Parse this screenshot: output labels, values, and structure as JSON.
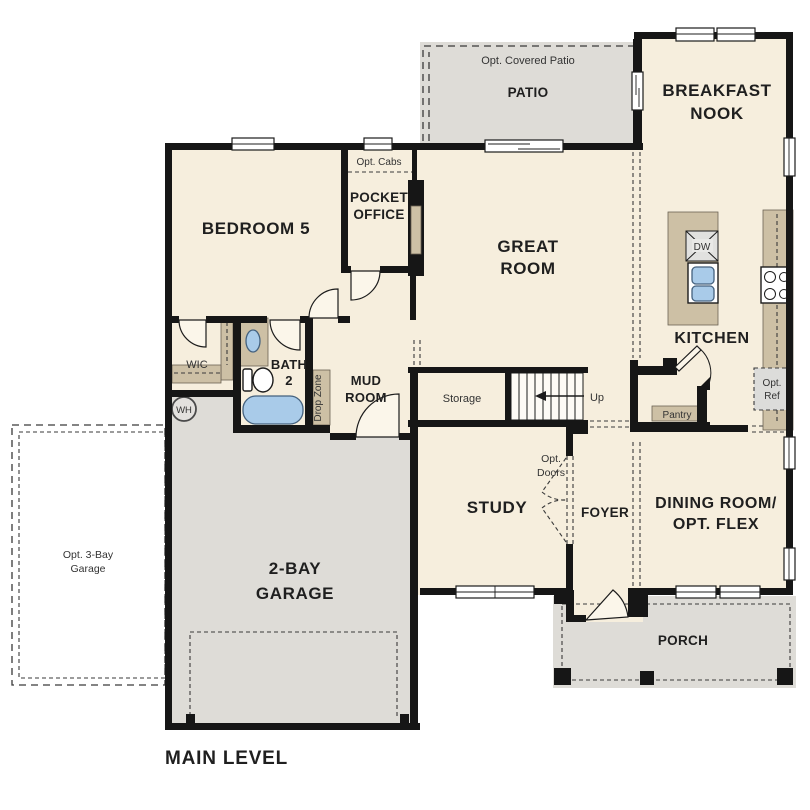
{
  "colors": {
    "floor": "#f6eedd",
    "outdoor": "#dedcd7",
    "wall": "#161616",
    "cabinetry": "#cdc0a5",
    "water_fixture": "#a9cbe9",
    "dashed_line": "#3a3a3a",
    "label_text": "#1f1f1f"
  },
  "outdoor": {
    "patio": {
      "label": "PATIO",
      "optional_label": "Opt. Covered Patio"
    },
    "porch": {
      "label": "PORCH"
    },
    "opt_garage": {
      "lines": [
        "Opt. 3-Bay",
        "Garage"
      ]
    }
  },
  "rooms": {
    "breakfast_nook": {
      "lines": [
        "BREAKFAST",
        "NOOK"
      ]
    },
    "bedroom5": {
      "label": "BEDROOM 5"
    },
    "pocket_office": {
      "lines": [
        "POCKET",
        "OFFICE"
      ],
      "optional_label": "Opt. Cabs"
    },
    "great_room": {
      "lines": [
        "GREAT",
        "ROOM"
      ]
    },
    "kitchen": {
      "label": "KITCHEN",
      "dishwasher": "DW",
      "pantry": "Pantry",
      "opt_ref_lines": [
        "Opt.",
        "Ref"
      ]
    },
    "wic": {
      "label": "WIC"
    },
    "bath2": {
      "lines": [
        "BATH",
        "2"
      ]
    },
    "mud_room": {
      "lines": [
        "MUD",
        "ROOM"
      ],
      "drop_zone": "Drop Zone"
    },
    "storage": {
      "label": "Storage"
    },
    "stairs": {
      "direction_label": "Up"
    },
    "water_heater": {
      "label": "WH"
    },
    "study": {
      "label": "STUDY",
      "opt_doors_lines": [
        "Opt.",
        "Doors"
      ]
    },
    "foyer": {
      "label": "FOYER"
    },
    "dining": {
      "lines": [
        "DINING ROOM/",
        "OPT. FLEX"
      ]
    },
    "garage": {
      "lines": [
        "2-BAY",
        "GARAGE"
      ]
    }
  },
  "footer": {
    "label": "MAIN LEVEL"
  }
}
